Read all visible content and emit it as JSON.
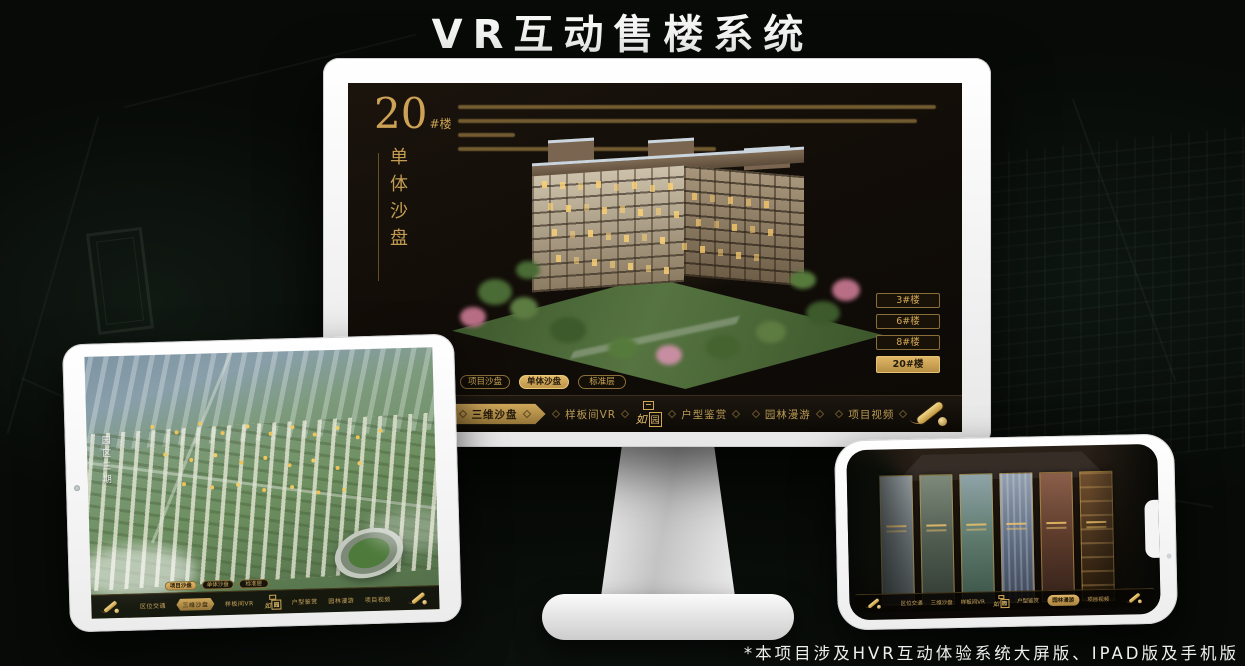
{
  "title": "VR互动售楼系统",
  "footnote": "*本项目涉及HVR互动体验系统大屏版、IPAD版及手机版",
  "colors": {
    "gold": "#d2a855",
    "gold_bright": "#e7c36a",
    "screen_bg": "#140e08",
    "ink": "#241a0c"
  },
  "logo": {
    "name": "如园",
    "left": "如",
    "right": "园"
  },
  "nav": {
    "left": [
      "区位交通",
      "三维沙盘",
      "样板间VR"
    ],
    "right": [
      "户型鉴赏",
      "园林漫游",
      "项目视频"
    ]
  },
  "subtabs": [
    "项目沙盘",
    "单体沙盘",
    "标准层"
  ],
  "monitor": {
    "heading_number": "20",
    "heading_suffix": "#楼",
    "heading_vertical": "单体沙盘",
    "active_subtab": "单体沙盘",
    "active_nav": "三维沙盘",
    "building_buttons": [
      "3#楼",
      "6#楼",
      "8#楼",
      "20#楼"
    ],
    "active_building_button": "20#楼"
  },
  "tablet": {
    "area_label": "园区三期",
    "active_subtab": "项目沙盘",
    "active_nav": "三维沙盘"
  },
  "phone": {
    "active_nav": "园林漫游",
    "panel_count": "6"
  }
}
